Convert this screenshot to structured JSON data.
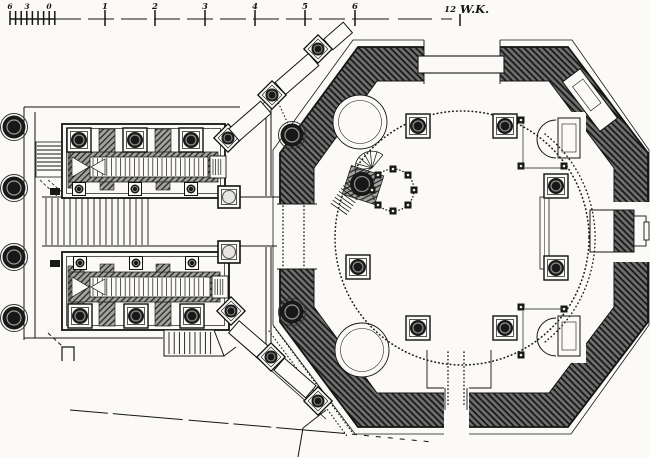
{
  "scale_bar": {
    "sub_labels": [
      "6",
      "3",
      "0"
    ],
    "major_labels": [
      "1",
      "2",
      "3",
      "4",
      "5",
      "6"
    ],
    "end_number": "12",
    "unit": "W.K."
  },
  "colors": {
    "paper": "#fbfaf6",
    "ink": "#161616",
    "wall_hatch_base": "#6f6f6f",
    "pier_hatch_base": "#a3a29e"
  }
}
